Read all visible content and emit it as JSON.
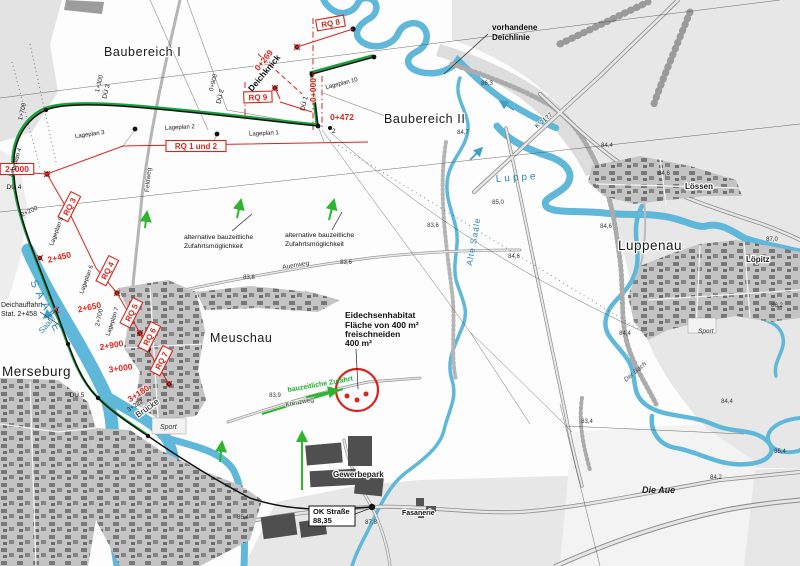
{
  "colors": {
    "water": "#5fb8da",
    "route_green": "#14a23b",
    "access_green": "#2db52d",
    "annotation_red": "#d8251b",
    "flow_blue": "#3d9fc8",
    "urban_gray": "#c4c4c4",
    "building_gray": "#6a6a6a"
  },
  "labels": {
    "baubereich_i": "Baubereich I",
    "baubereich_ii": "Baubereich II",
    "merseburg": "Merseburg",
    "meuschau": "Meuschau",
    "luppenau": "Luppenau",
    "loessen": "Lössen",
    "loepitz": "Löpitz",
    "gewerbepark": "Gewerbepark",
    "fasanerie": "Fasanerie",
    "die_aue": "Die Aue",
    "sport_1": "Sport",
    "sport_2": "Sport",
    "bruecke": "Brücke",
    "deichknick": "Deichknick",
    "vorhandene_1": "vorhandene",
    "vorhandene_2": "Deichlinie",
    "deichauffahrt_1": "Deichauffahrt",
    "deichauffahrt_2": "Stat. 2+458",
    "punkt_2": "2"
  },
  "water_labels": {
    "saale_caps": "SAALE",
    "saale": "Saale",
    "luppe": "Luppe",
    "alte_saale": "Alte Saale",
    "der_bach": "Der Bach"
  },
  "habitat_note": {
    "l1": "Eidechsenhabitat",
    "l2": "Fläche von 400 m²",
    "l3": "freischneiden",
    "l4": "400 m²"
  },
  "access_note": {
    "alt_l1": "alternative bauzeitliche",
    "alt_l2": "Zufahrtsmöglichkeit",
    "bauzeitlich": "bauzeitliche Zufahrt"
  },
  "ok_strasse": {
    "l1": "OK Straße",
    "l2": "88,35"
  },
  "rq_sections": [
    {
      "text": "RQ 8",
      "x": 331,
      "y": 26,
      "rot": -10,
      "box": true
    },
    {
      "text": "RQ 9",
      "x": 258,
      "y": 100,
      "rot": -2,
      "box": true
    },
    {
      "text": "RQ 1 und 2",
      "x": 196,
      "y": 149,
      "rot": 0,
      "box": true
    },
    {
      "text": "RQ 3",
      "x": 72,
      "y": 208,
      "rot": -63,
      "box": true
    },
    {
      "text": "RQ 4",
      "x": 110,
      "y": 272,
      "rot": -63,
      "box": true
    },
    {
      "text": "RQ 5",
      "x": 134,
      "y": 314,
      "rot": -63,
      "box": true
    },
    {
      "text": "RQ 6",
      "x": 152,
      "y": 338,
      "rot": -63,
      "box": true
    },
    {
      "text": "RQ 7",
      "x": 164,
      "y": 362,
      "rot": -63,
      "box": true
    }
  ],
  "stations_red": [
    {
      "text": "2+000",
      "x": 17,
      "y": 172,
      "rot": 0,
      "box": true
    },
    {
      "text": "2+450",
      "x": 60,
      "y": 260,
      "rot": -14
    },
    {
      "text": "2+650",
      "x": 90,
      "y": 310,
      "rot": -12
    },
    {
      "text": "2+900",
      "x": 112,
      "y": 348,
      "rot": -10
    },
    {
      "text": "3+000",
      "x": 121,
      "y": 371,
      "rot": -8
    },
    {
      "text": "3+180",
      "x": 140,
      "y": 396,
      "rot": -33
    },
    {
      "text": "0+269",
      "x": 266,
      "y": 62,
      "rot": -52
    },
    {
      "text": "0+000",
      "x": 316,
      "y": 90,
      "rot": -90
    },
    {
      "text": "0+472",
      "x": 342,
      "y": 120,
      "rot": 0
    }
  ],
  "stations_black": [
    {
      "text": "2+200",
      "x": 30,
      "y": 213,
      "rot": -25
    },
    {
      "text": "2+700",
      "x": 101,
      "y": 318,
      "rot": -78
    },
    {
      "text": "3+222",
      "x": 136,
      "y": 407,
      "rot": -33
    },
    {
      "text": "0+900",
      "x": 215,
      "y": 83,
      "rot": -76
    },
    {
      "text": "1+700",
      "x": 24,
      "y": 112,
      "rot": -76
    },
    {
      "text": "1+300",
      "x": 101,
      "y": 84,
      "rot": -76
    }
  ],
  "du_points": [
    {
      "text": "DÜ 1",
      "x": 306,
      "y": 104,
      "rot": -76
    },
    {
      "text": "DÜ 2",
      "x": 222,
      "y": 97,
      "rot": -76
    },
    {
      "text": "DÜ 3",
      "x": 108,
      "y": 92,
      "rot": -76
    },
    {
      "text": "DÜ 4",
      "x": 14,
      "y": 189,
      "rot": 0
    },
    {
      "text": "DÜ 5",
      "x": 77,
      "y": 397,
      "rot": 0
    }
  ],
  "lageplan_sheets": [
    {
      "text": "Lageplan 1",
      "x": 264,
      "y": 135,
      "rot": -3
    },
    {
      "text": "Lageplan 2",
      "x": 180,
      "y": 129,
      "rot": -3
    },
    {
      "text": "Lageplan 3",
      "x": 90,
      "y": 136,
      "rot": -8
    },
    {
      "text": "Lageplan 4",
      "x": 17,
      "y": 163,
      "rot": -72
    },
    {
      "text": "Lageplan 5",
      "x": 58,
      "y": 232,
      "rot": -70
    },
    {
      "text": "Lageplan 6",
      "x": 88,
      "y": 280,
      "rot": -70
    },
    {
      "text": "Lageplan 7",
      "x": 114,
      "y": 322,
      "rot": -72
    },
    {
      "text": "Lageplan 10",
      "x": 342,
      "y": 85,
      "rot": -14
    }
  ],
  "elevations": [
    {
      "text": "86,3",
      "x": 487,
      "y": 85
    },
    {
      "text": "84,7",
      "x": 463,
      "y": 134
    },
    {
      "text": "84,4",
      "x": 607,
      "y": 147
    },
    {
      "text": "84,6",
      "x": 664,
      "y": 175
    },
    {
      "text": "85,0",
      "x": 498,
      "y": 204
    },
    {
      "text": "84,6",
      "x": 606,
      "y": 228
    },
    {
      "text": "83,6",
      "x": 433,
      "y": 227
    },
    {
      "text": "84,6",
      "x": 514,
      "y": 258
    },
    {
      "text": "87,0",
      "x": 772,
      "y": 241
    },
    {
      "text": "86,2",
      "x": 777,
      "y": 307
    },
    {
      "text": "84,4",
      "x": 625,
      "y": 335
    },
    {
      "text": "83,8",
      "x": 249,
      "y": 279
    },
    {
      "text": "83,6",
      "x": 346,
      "y": 264
    },
    {
      "text": "83,9",
      "x": 275,
      "y": 397
    },
    {
      "text": "87,8",
      "x": 371,
      "y": 524
    },
    {
      "text": "83,4",
      "x": 587,
      "y": 423
    },
    {
      "text": "84,2",
      "x": 716,
      "y": 479
    },
    {
      "text": "84,4",
      "x": 727,
      "y": 403
    },
    {
      "text": "85,4",
      "x": 780,
      "y": 453
    },
    {
      "text": "85,4",
      "x": 243,
      "y": 519
    }
  ],
  "road_names": [
    {
      "text": "Kreuzweg",
      "x": 300,
      "y": 404,
      "rot": -10
    },
    {
      "text": "Auenweg",
      "x": 296,
      "y": 267,
      "rot": -9
    },
    {
      "text": "Feldweg",
      "x": 150,
      "y": 180,
      "rot": -84
    },
    {
      "text": "K 2177",
      "x": 545,
      "y": 122,
      "rot": -40
    }
  ]
}
